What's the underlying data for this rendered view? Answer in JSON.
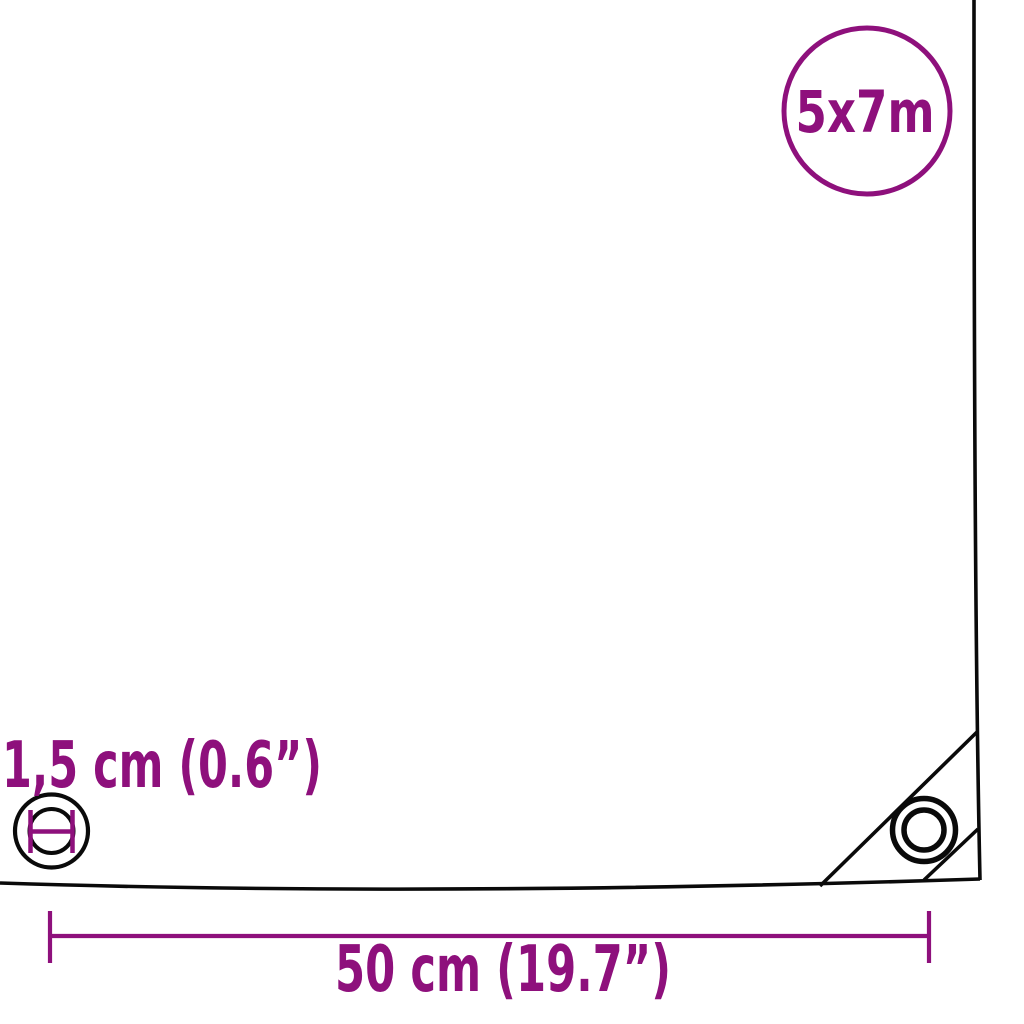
{
  "badge": {
    "size_label": "5x7m"
  },
  "annotations": {
    "grommet_diameter_label": "1,5 cm (0.6”)",
    "grommet_spacing_label": "50 cm (19.7”)"
  },
  "colors": {
    "accent_purple": "#8E107C",
    "outline_black": "#0A0A0A",
    "background": "#FFFFFF"
  }
}
